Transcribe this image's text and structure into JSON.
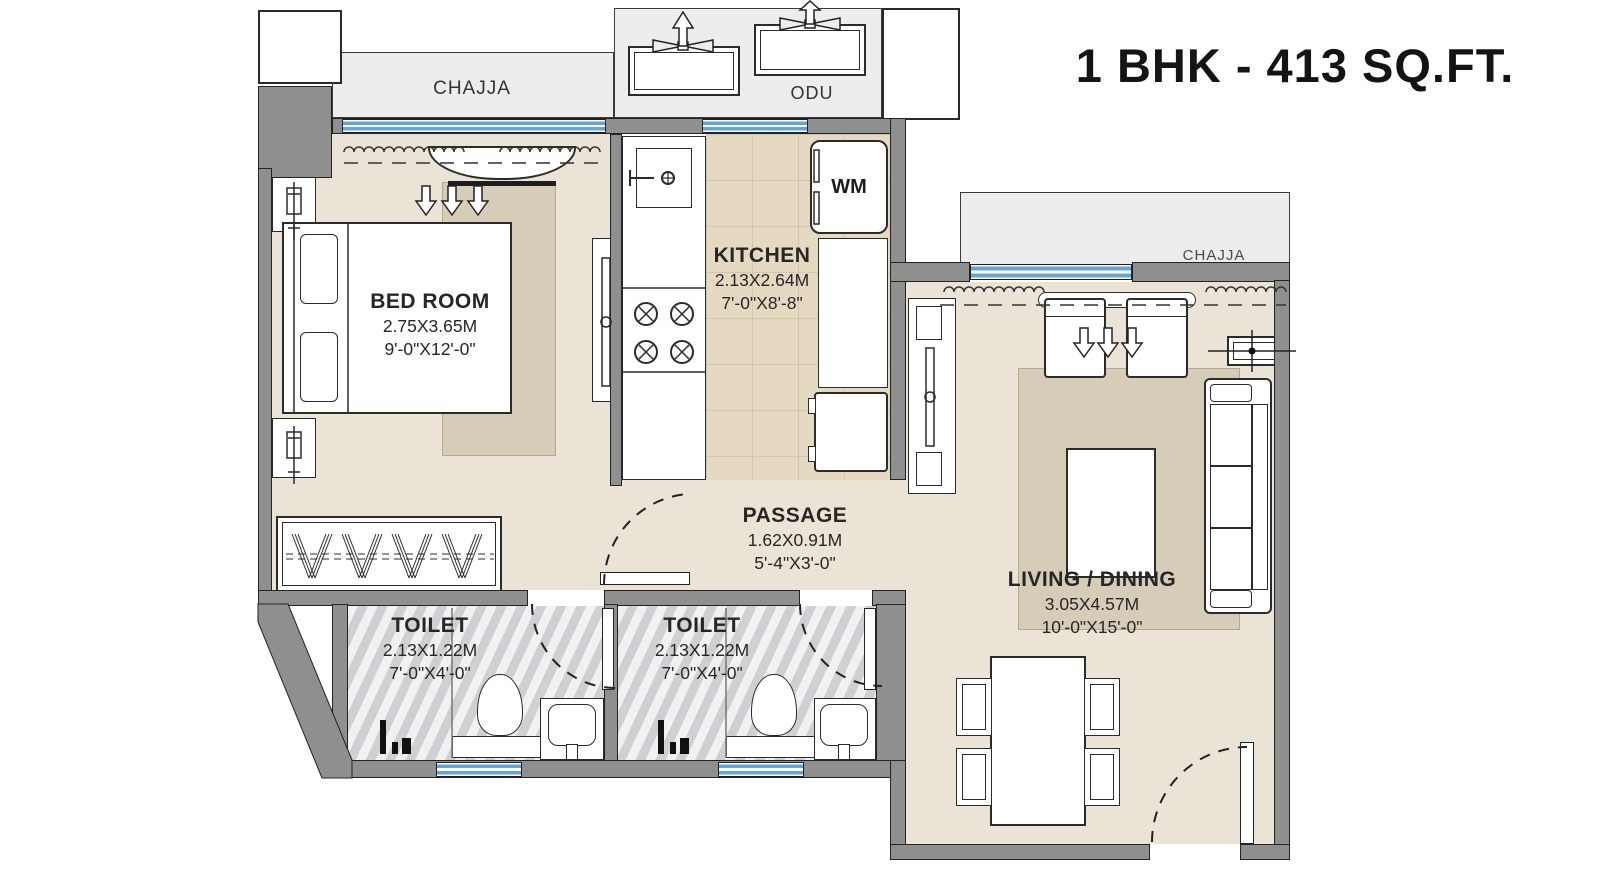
{
  "title": "1 BHK - 413 SQ.FT.",
  "labels": {
    "chajja": "CHAJJA",
    "odu": "ODU",
    "wm": "WM"
  },
  "rooms": [
    {
      "id": "bedroom",
      "name": "BED ROOM",
      "size_m": "2.75X3.65M",
      "size_ft": "9'-0\"X12'-0\""
    },
    {
      "id": "kitchen",
      "name": "KITCHEN",
      "size_m": "2.13X2.64M",
      "size_ft": "7'-0\"X8'-8\""
    },
    {
      "id": "passage",
      "name": "PASSAGE",
      "size_m": "1.62X0.91M",
      "size_ft": "5'-4\"X3'-0\""
    },
    {
      "id": "toilet-1",
      "name": "TOILET",
      "size_m": "2.13X1.22M",
      "size_ft": "7'-0\"X4'-0\""
    },
    {
      "id": "toilet-2",
      "name": "TOILET",
      "size_m": "2.13X1.22M",
      "size_ft": "7'-0\"X4'-0\""
    },
    {
      "id": "living-dining",
      "name": "LIVING / DINING",
      "size_m": "3.05X4.57M",
      "size_ft": "10'-0\"X15'-0\""
    }
  ],
  "colors": {
    "wall_gray": "#8f8f8f",
    "window_blue": "#64a5d9",
    "floor_beige": "#ebe4d6",
    "kitchen_tile": "#e6d9c2",
    "toilet_marble": "#dcdcdf",
    "chajja_gray": "#ededed",
    "line_dark": "#232323"
  }
}
